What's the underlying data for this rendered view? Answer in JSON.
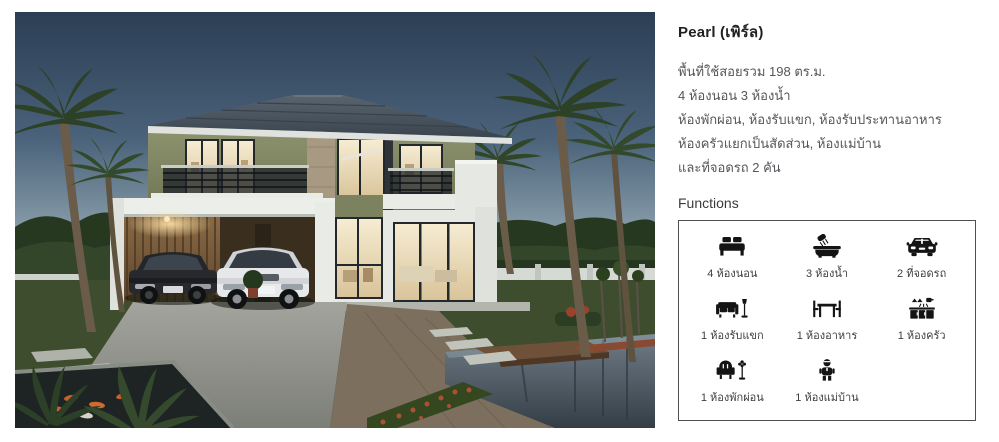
{
  "hero": {
    "name": "house-rendering",
    "description": "Two-storey house at dusk with carport, two cars, palm trees, koi pond and reflecting pool",
    "colors": {
      "sky_top": "#2b3e54",
      "sky_horizon": "#c2cdd0",
      "roof": "#4b5661",
      "wall_green": "#878c68",
      "wall_white": "#eceeea",
      "window_light": "#f2e6c4",
      "grass": "#3e4d2d",
      "pool": "#525f69",
      "driveway": "#9a9c95"
    }
  },
  "listing": {
    "title": "Pearl (เพิร์ล)",
    "description_lines": [
      "พื้นที่ใช้สอยรวม 198 ตร.ม.",
      "4 ห้องนอน 3 ห้องน้ำ",
      "ห้องพักผ่อน, ห้องรับแขก, ห้องรับประทานอาหาร",
      "ห้องครัวแยกเป็นสัดส่วน, ห้องแม่บ้าน",
      "และที่จอดรถ 2 คัน"
    ],
    "functions_heading": "Functions",
    "functions": [
      {
        "icon": "bed-icon",
        "label": "4 ห้องนอน"
      },
      {
        "icon": "bath-icon",
        "label": "3 ห้องน้ำ"
      },
      {
        "icon": "car-icon",
        "label": "2 ที่จอดรถ"
      },
      {
        "icon": "sofa-icon",
        "label": "1 ห้องรับแขก"
      },
      {
        "icon": "dining-table-icon",
        "label": "1 ห้องอาหาร"
      },
      {
        "icon": "kitchen-icon",
        "label": "1 ห้องครัว"
      },
      {
        "icon": "armchair-icon",
        "label": "1 ห้องพักผ่อน"
      },
      {
        "icon": "maid-icon",
        "label": "1 ห้องแม่บ้าน"
      }
    ],
    "box_border_color": "#4f5052",
    "text_color": "#55565a"
  }
}
